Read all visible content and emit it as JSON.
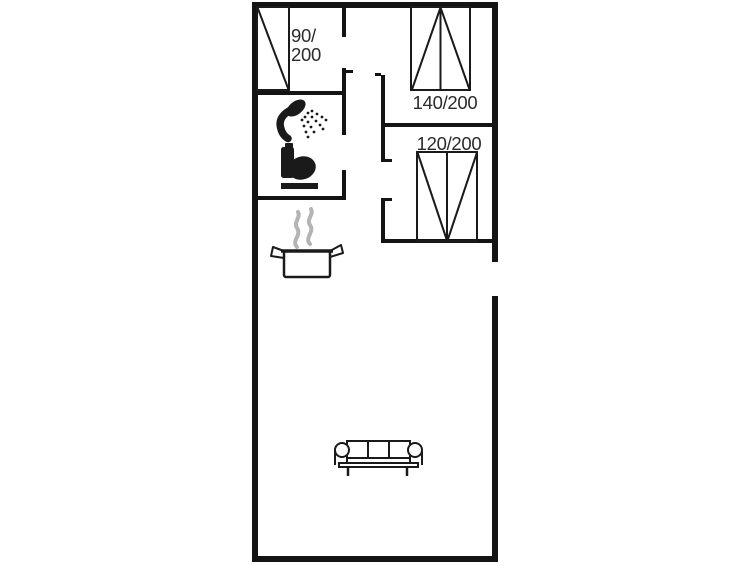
{
  "floorplan": {
    "colors": {
      "wall": "#141414",
      "line": "#1a1a1a",
      "steam": "#b4b4b4",
      "text": "#2b2b2b",
      "bg": "#ffffff"
    },
    "beds": {
      "single": {
        "line1": "90/",
        "line2": "200"
      },
      "double": {
        "label": "140/200"
      },
      "wide": {
        "label": "120/200"
      }
    },
    "icons": {
      "shower": "shower-icon",
      "toilet": "toilet-icon",
      "pot": "cooking-pot-icon",
      "sofa": "sofa-icon",
      "bed_single": "single-bed-icon",
      "bed_double": "double-bed-icon",
      "bed_wide": "wide-bed-icon"
    }
  }
}
